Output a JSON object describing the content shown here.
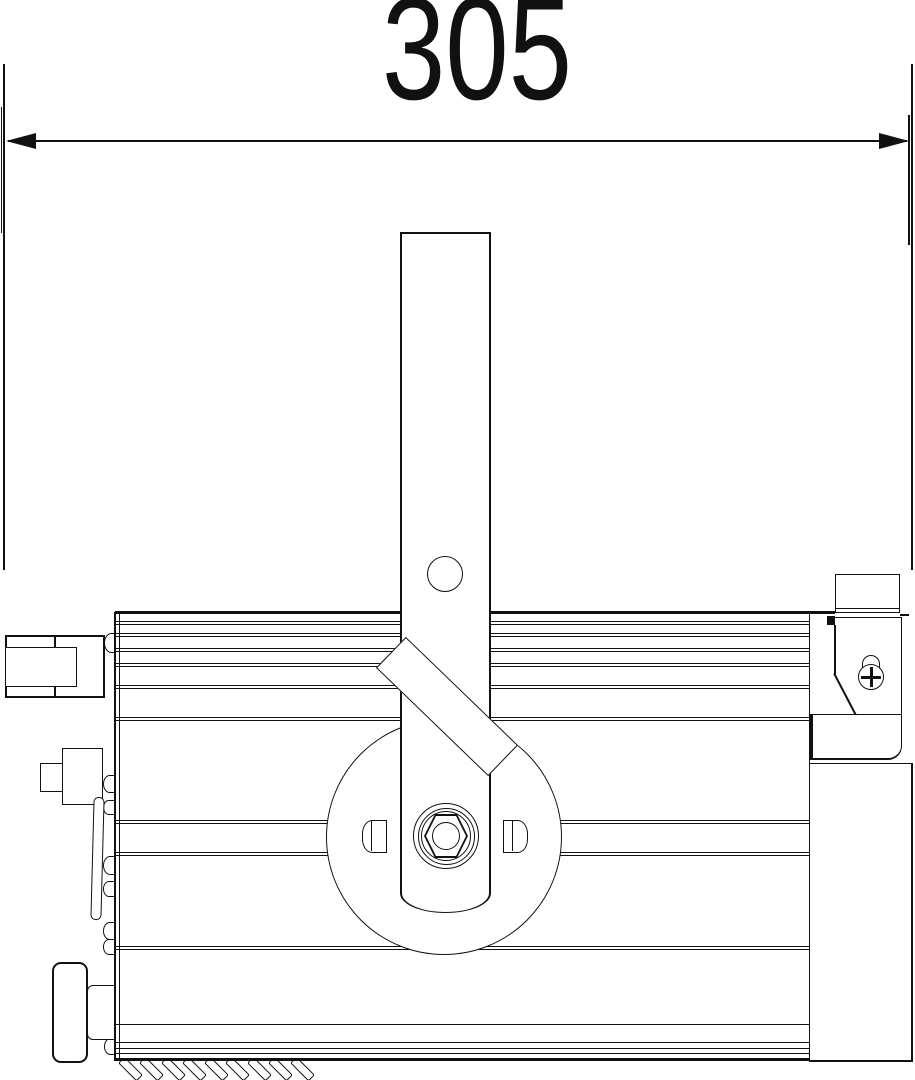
{
  "dimension": {
    "value": "305"
  },
  "colors": {
    "line": "#111111",
    "background": "#ffffff"
  }
}
